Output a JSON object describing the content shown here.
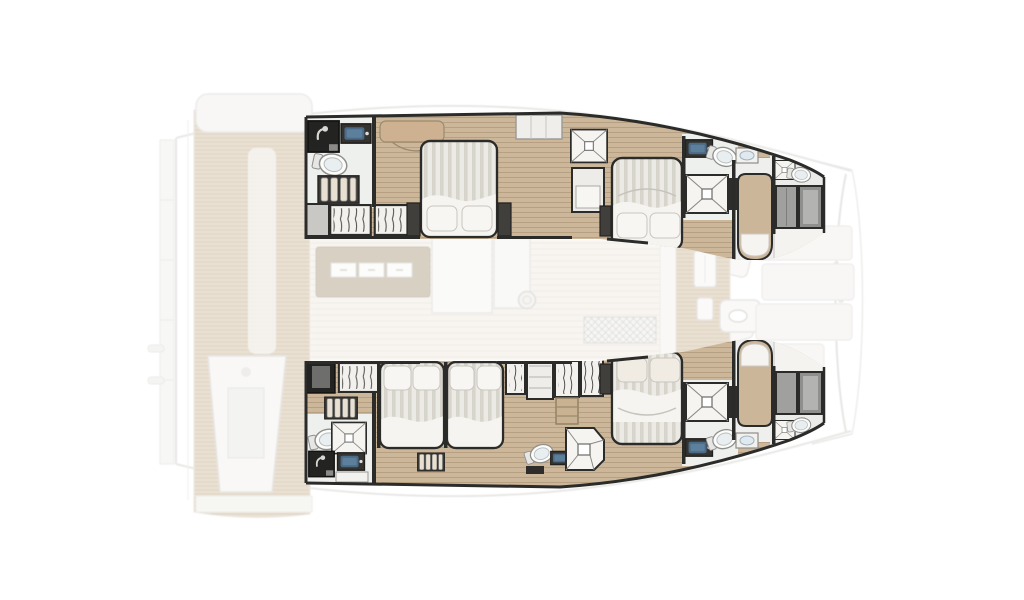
{
  "plan": {
    "vessel_view": "catamaran top-down accommodation floor plan",
    "berth_summary": {
      "double_beds": 5,
      "single_berths": 2,
      "toilets": 7,
      "shower_trays": 7,
      "enclosed_showers": 2,
      "wardrobes": 7
    },
    "cockpit": {
      "features": [
        "teak-deck",
        "aft-bench",
        "walkway",
        "helm-console",
        "swim-platform",
        "ladder"
      ]
    },
    "saloon": {
      "features": [
        "galley-island",
        "drawer-fronts",
        "galley-counter",
        "cabinet",
        "deck-hatch",
        "dinette-table",
        "angled-seats"
      ],
      "drawer_count": 3
    },
    "foredeck": {
      "features": [
        "teak-walkway",
        "deck-hatch",
        "foredeck-seat",
        "bow-sunpads",
        "trampoline-outline",
        "bow-cleats"
      ]
    },
    "port_hull": {
      "rooms": [
        {
          "name": "aft-head",
          "fixtures": [
            "enclosed-shower",
            "washbasin",
            "toilet"
          ]
        },
        {
          "name": "companionway-steps"
        },
        {
          "name": "wardrobes"
        },
        {
          "name": "aft-cabin",
          "berth": "double-bed",
          "extras": [
            "vanity-desk",
            "bedside-units"
          ]
        },
        {
          "name": "mid-shower-room",
          "fixtures": [
            "shower-tray",
            "cabinet"
          ]
        },
        {
          "name": "forward-cabin",
          "berth": "double-bed"
        },
        {
          "name": "forward-head",
          "fixtures": [
            "washbasin",
            "toilet",
            "washbasin",
            "shower-tray"
          ]
        },
        {
          "name": "forepeak-cabin",
          "berth": "single-berth"
        },
        {
          "name": "bow-compartment",
          "fixtures": [
            "shower-tray",
            "toilet",
            "cushioned-lockers"
          ]
        }
      ]
    },
    "starboard_hull": {
      "rooms": [
        {
          "name": "aft-head",
          "fixtures": [
            "toilet",
            "shower-tray",
            "enclosed-shower",
            "washbasin",
            "bench"
          ]
        },
        {
          "name": "companionway-steps"
        },
        {
          "name": "wardrobes"
        },
        {
          "name": "aft-cabin-inner",
          "berth": "double-bed"
        },
        {
          "name": "aft-cabin-outer",
          "berth": "double-bed"
        },
        {
          "name": "mid-head",
          "fixtures": [
            "toilet",
            "washbasin",
            "shower-tray"
          ]
        },
        {
          "name": "forward-cabin",
          "berth": "double-bed"
        },
        {
          "name": "forward-head",
          "fixtures": [
            "washbasin",
            "toilet",
            "washbasin",
            "shower-tray"
          ]
        },
        {
          "name": "forepeak-cabin",
          "berth": "single-berth"
        },
        {
          "name": "bow-compartment",
          "fixtures": [
            "shower-tray",
            "toilet",
            "cushioned-lockers"
          ]
        }
      ]
    },
    "palette": {
      "background": "#ffffff",
      "hull_floor_wood": "#cdb79a",
      "ghost_teak": "#d8c5a7",
      "wall_dark": "#2b2b2a",
      "furniture_light": "#edece8",
      "duvet_stripe": "#d7d4cc",
      "pillow_white": "#f8f6f2",
      "galley_island_tan": "#b4a28a",
      "sink_blue": "#4a6a86",
      "cushion_grey": "#9b9b99",
      "ghost_outline": "#d3d2ce",
      "toilet_white": "#fcfcfb"
    }
  }
}
